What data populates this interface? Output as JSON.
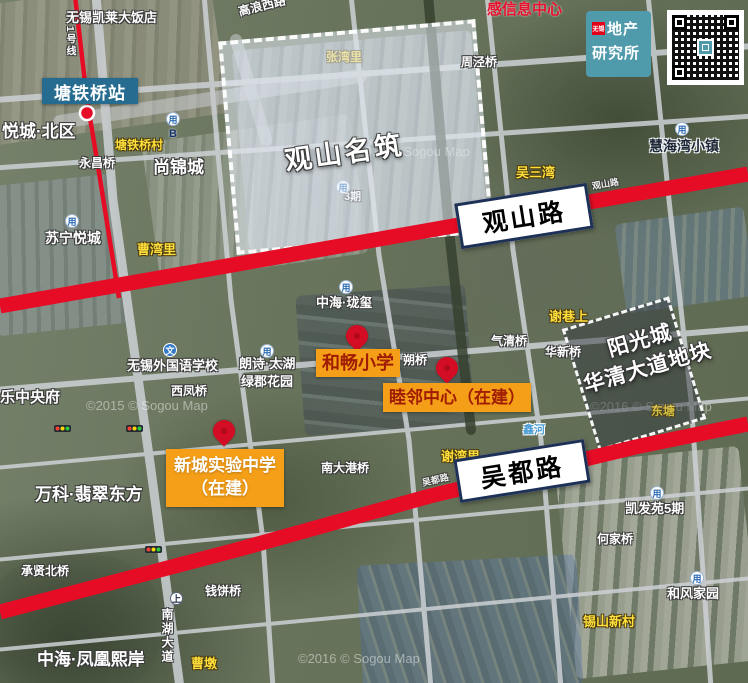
{
  "brand": {
    "badge": "无锡",
    "line1": "地产",
    "line2": "研究所"
  },
  "station": {
    "name": "塘铁桥站",
    "line_label": "1号线"
  },
  "roads": {
    "guanshan_box": "观山路",
    "wudu_box": "吴都路"
  },
  "zones": {
    "guanshan": {
      "name": "观山名筑"
    },
    "yangguang": {
      "line1": "阳光城",
      "line2": "华清大道地块"
    }
  },
  "poi": {
    "hechang": "和畅小学",
    "mulin": "睦邻中心（在建）",
    "xincheng": {
      "line1": "新城实验中学",
      "line2": "（在建）"
    }
  },
  "colors": {
    "highlight_red": "#e60c26",
    "poi_orange": "#f59f18",
    "poi_text_red": "#a01d03",
    "station_teal": "#266c90",
    "brand_teal": "#4f9aab",
    "box_border_navy": "#1d3056",
    "label_yellow": "#ffdf3a"
  },
  "labels": [
    {
      "t": "无锡凯莱大饭店",
      "x": 66,
      "y": 11,
      "c": "w",
      "s": 13
    },
    {
      "t": "高浪西路",
      "x": 238,
      "y": 0,
      "c": "w",
      "s": 12,
      "r": -14
    },
    {
      "t": "感信息中心",
      "x": 487,
      "y": 2,
      "c": "r",
      "s": 15
    },
    {
      "t": "周泾桥",
      "x": 461,
      "y": 56,
      "c": "w",
      "s": 12
    },
    {
      "t": "悦城·北区",
      "x": 2,
      "y": 123,
      "c": "w",
      "s": 17
    },
    {
      "t": "塘铁桥村",
      "x": 115,
      "y": 139,
      "c": "y",
      "s": 12
    },
    {
      "t": "慧海湾小镇",
      "x": 649,
      "y": 139,
      "c": "dk",
      "s": 14
    },
    {
      "t": "永昌桥",
      "x": 79,
      "y": 157,
      "c": "w",
      "s": 12
    },
    {
      "t": "尚锦城",
      "x": 153,
      "y": 159,
      "c": "w",
      "s": 17
    },
    {
      "t": "吴三湾",
      "x": 516,
      "y": 166,
      "c": "y",
      "s": 13
    },
    {
      "t": "张湾里",
      "x": 326,
      "y": 51,
      "c": "y",
      "s": 12,
      "z": 1,
      "o": 0.85
    },
    {
      "t": "3期",
      "x": 344,
      "y": 192,
      "c": "w",
      "s": 11,
      "z": 1
    },
    {
      "t": "苏宁悦城",
      "x": 45,
      "y": 231,
      "c": "w",
      "s": 14
    },
    {
      "t": "曹湾里",
      "x": 137,
      "y": 243,
      "c": "y",
      "s": 13
    },
    {
      "t": "中海·珑玺",
      "x": 316,
      "y": 296,
      "c": "w",
      "s": 13
    },
    {
      "t": "谢巷上",
      "x": 549,
      "y": 310,
      "c": "y",
      "s": 13
    },
    {
      "t": "气清桥",
      "x": 491,
      "y": 335,
      "c": "w",
      "s": 12
    },
    {
      "t": "华新桥",
      "x": 545,
      "y": 346,
      "c": "w",
      "s": 12
    },
    {
      "t": "朔桥",
      "x": 403,
      "y": 354,
      "c": "w",
      "s": 12
    },
    {
      "t": "无锡外国语学校",
      "x": 127,
      "y": 359,
      "c": "w",
      "s": 13
    },
    {
      "t": "朗诗·太湖",
      "x": 239,
      "y": 357,
      "c": "w",
      "s": 13
    },
    {
      "t": "绿郡花园",
      "x": 241,
      "y": 375,
      "c": "w",
      "s": 13
    },
    {
      "t": "西凤桥",
      "x": 171,
      "y": 385,
      "c": "w",
      "s": 12
    },
    {
      "t": "乐中央府",
      "x": 0,
      "y": 390,
      "c": "w",
      "s": 15
    },
    {
      "t": "鑫河",
      "x": 523,
      "y": 425,
      "c": "b",
      "s": 11
    },
    {
      "t": "东塘",
      "x": 651,
      "y": 405,
      "c": "y",
      "s": 12,
      "o": 0.75
    },
    {
      "t": "谢湾里",
      "x": 441,
      "y": 450,
      "c": "y",
      "s": 13
    },
    {
      "t": "南大港桥",
      "x": 321,
      "y": 462,
      "c": "w",
      "s": 12
    },
    {
      "t": "万科·翡翠东方",
      "x": 35,
      "y": 486,
      "c": "w",
      "s": 17
    },
    {
      "t": "凯发苑5期",
      "x": 625,
      "y": 502,
      "c": "w",
      "s": 13
    },
    {
      "t": "何家桥",
      "x": 597,
      "y": 533,
      "c": "w",
      "s": 12
    },
    {
      "t": "承贤北桥",
      "x": 21,
      "y": 565,
      "c": "w",
      "s": 12
    },
    {
      "t": "钱饼桥",
      "x": 205,
      "y": 585,
      "c": "w",
      "s": 12
    },
    {
      "t": "和风家园",
      "x": 667,
      "y": 587,
      "c": "w",
      "s": 13
    },
    {
      "t": "锡山新村",
      "x": 583,
      "y": 615,
      "c": "y",
      "s": 13
    },
    {
      "t": "南湖大道",
      "x": 161,
      "y": 608,
      "c": "w vert",
      "s": 12
    },
    {
      "t": "曹墩",
      "x": 191,
      "y": 657,
      "c": "y",
      "s": 13
    },
    {
      "t": "中海·凤凰熙岸",
      "x": 37,
      "y": 651,
      "c": "w",
      "s": 17
    },
    {
      "t": "1号线",
      "x": 64,
      "y": 26,
      "c": "w vert",
      "s": 10
    },
    {
      "t": "观山路",
      "x": 592,
      "y": 180,
      "c": "w",
      "s": 9,
      "r": -10,
      "o": 0.9
    },
    {
      "t": "吴都路",
      "x": 422,
      "y": 476,
      "c": "w",
      "s": 9,
      "r": -13,
      "o": 0.9
    }
  ],
  "watermarks": [
    {
      "t": "©2015 © Sogou Map",
      "x": 86,
      "y": 399
    },
    {
      "t": "©2015 © Sogou Map",
      "x": 348,
      "y": 145,
      "z": 1
    },
    {
      "t": "©2016 © Sogou Map",
      "x": 298,
      "y": 652
    },
    {
      "t": "©2016 © Sogou Map",
      "x": 590,
      "y": 400,
      "z": 1
    }
  ],
  "icons": [
    {
      "k": "entb",
      "x": 166,
      "y": 112,
      "g": "用",
      "t": "B"
    },
    {
      "k": "metro",
      "x": 65,
      "y": 214,
      "g": "用"
    },
    {
      "k": "metro",
      "x": 339,
      "y": 280,
      "g": "用"
    },
    {
      "k": "metro",
      "x": 260,
      "y": 344,
      "g": "用"
    },
    {
      "k": "metro",
      "x": 675,
      "y": 122,
      "g": "用"
    },
    {
      "k": "metro",
      "x": 650,
      "y": 486,
      "g": "用"
    },
    {
      "k": "metro",
      "x": 690,
      "y": 571,
      "g": "用"
    },
    {
      "k": "metro",
      "x": 336,
      "y": 180,
      "g": "用",
      "z": 1
    },
    {
      "k": "wen",
      "x": 163,
      "y": 343,
      "g": "文"
    },
    {
      "k": "lshang",
      "x": 170,
      "y": 592,
      "g": "上"
    },
    {
      "k": "traffic",
      "x": 54,
      "y": 425
    },
    {
      "k": "traffic",
      "x": 126,
      "y": 425
    },
    {
      "k": "traffic",
      "x": 145,
      "y": 546
    }
  ],
  "pins": [
    {
      "x": 357,
      "y": 352,
      "for": "和畅小学"
    },
    {
      "x": 447,
      "y": 384,
      "for": "睦邻中心（在建）"
    },
    {
      "x": 224,
      "y": 447,
      "for": "新城实验中学（在建）"
    }
  ]
}
